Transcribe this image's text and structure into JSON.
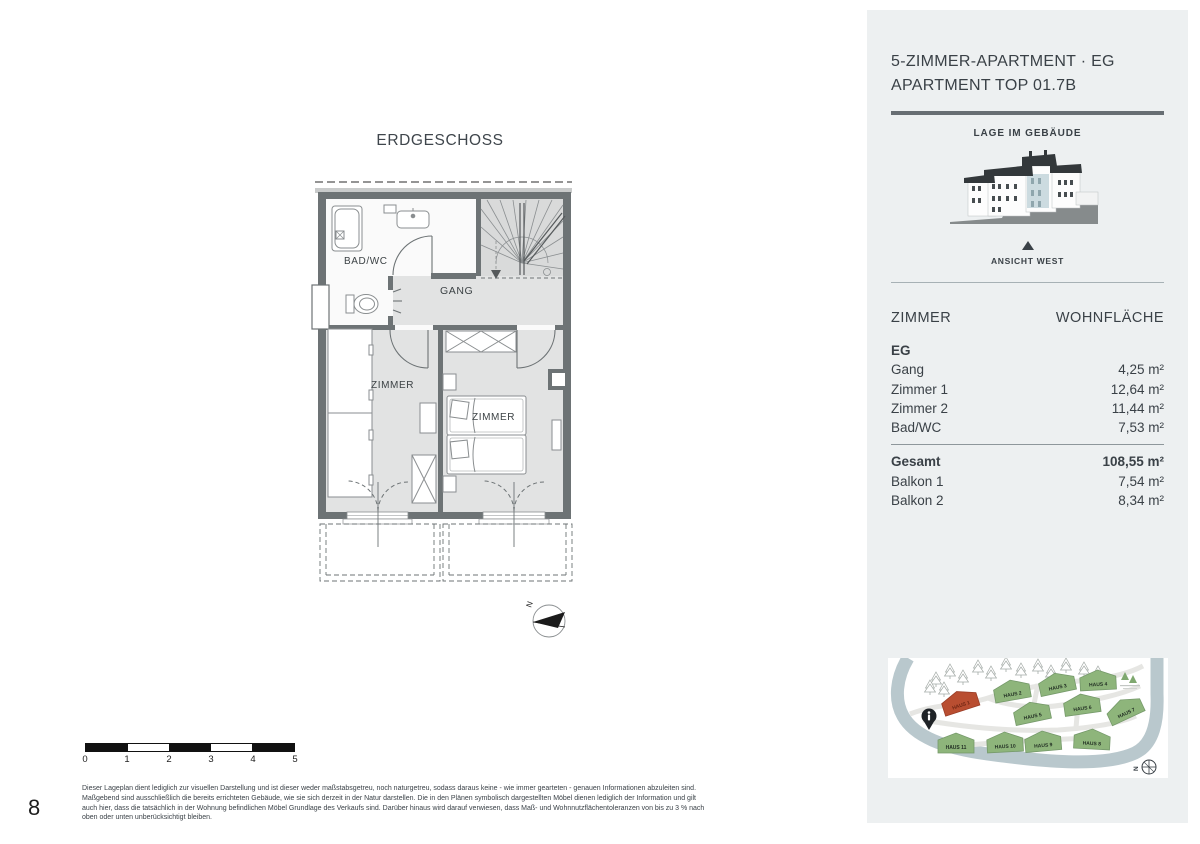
{
  "page": {
    "number": "8"
  },
  "plan": {
    "title": "ERDGESCHOSS",
    "rooms": {
      "bad_wc": "BAD/WC",
      "gang": "GANG",
      "zimmer_left": "ZIMMER",
      "zimmer_right": "ZIMMER"
    },
    "north_label": "N"
  },
  "scalebar": {
    "ticks": [
      "0",
      "1",
      "2",
      "3",
      "4",
      "5"
    ]
  },
  "disclaimer": {
    "lines": [
      "Dieser Lageplan dient lediglich zur visuellen Darstellung und ist dieser weder maßstabsgetreu, noch naturgetreu, sodass daraus keine - wie immer gearteten - genauen Informationen abzuleiten sind.",
      "Maßgebend sind ausschließlich die bereits errichteten Gebäude, wie sie sich derzeit in der Natur darstellen. Die in den Plänen symbolisch dargestellten Möbel dienen lediglich der Information und gilt",
      "auch hier, dass die tatsächlich in der Wohnung befindlichen Möbel Grundlage des Verkaufs sind. Darüber hinaus wird darauf verwiesen, dass Maß- und Wohnnutzflächentoleranzen von bis zu 3 % nach",
      "oben oder unten unberücksichtigt bleiben."
    ]
  },
  "sidebar": {
    "title_line1": "5-ZIMMER-APARTMENT · EG",
    "title_line2": "APARTMENT TOP 01.7B",
    "location_heading": "LAGE IM GEBÄUDE",
    "view_label": "ANSICHT WEST",
    "area_table": {
      "col_room": "ZIMMER",
      "col_area": "WOHNFLÄCHE",
      "floor_label": "EG",
      "rows": [
        {
          "label": "Gang",
          "value": "4,25 m²"
        },
        {
          "label": "Zimmer 1",
          "value": "12,64 m²"
        },
        {
          "label": "Zimmer 2",
          "value": "11,44 m²"
        },
        {
          "label": "Bad/WC",
          "value": "7,53 m²"
        }
      ],
      "total_label": "Gesamt",
      "total_value": "108,55 m²",
      "extra_rows": [
        {
          "label": "Balkon 1",
          "value": "7,54 m²"
        },
        {
          "label": "Balkon 2",
          "value": "8,34 m²"
        }
      ]
    },
    "sitemap": {
      "houses": [
        "HAUS 1",
        "HAUS 2",
        "HAUS 3",
        "HAUS 4",
        "HAUS 5",
        "HAUS 6",
        "HAUS 7",
        "HAUS 8",
        "HAUS 9",
        "HAUS 10",
        "HAUS 11"
      ],
      "compass_label": "N"
    }
  },
  "colors": {
    "sidebar_bg": "#edf0f1",
    "text_dark": "#3a4147",
    "wall_gray": "#6d7375",
    "room_shaded": "#e2e3e3",
    "apartment_highlight": "#ccdbe0",
    "house_green": "#8eb57b",
    "house_red": "#b94e31",
    "map_band": "#b9c8cd"
  }
}
